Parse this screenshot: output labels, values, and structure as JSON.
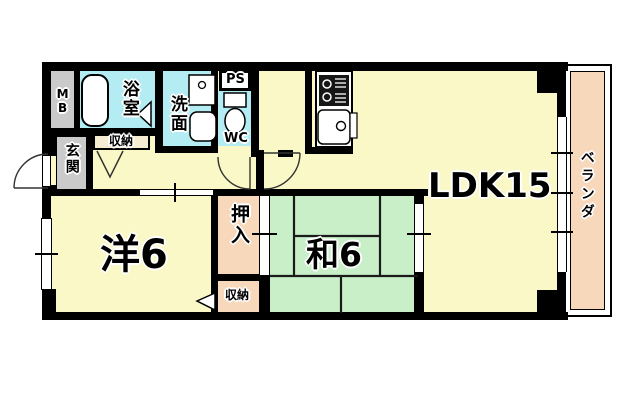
{
  "colors": {
    "floor_yellow": "#FAF8C6",
    "wet_area_cyan": "#B4ECF4",
    "tatami_green": "#C9EFC8",
    "closet_peach": "#F7D8BA",
    "entry_gray": "#CACACA",
    "hall_closet_cream": "#F5ECD2",
    "wall_black": "#000000",
    "background_white": "#FFFFFF"
  },
  "rooms": {
    "ldk": {
      "label": "LDK15"
    },
    "western": {
      "label": "洋6"
    },
    "japanese": {
      "label": "和6"
    },
    "oshiire": {
      "label": "押入"
    },
    "storage_lower": {
      "label": "収納"
    },
    "storage_hall": {
      "label": "収納"
    },
    "genkan": {
      "label": "玄関"
    },
    "bath": {
      "label": "浴室"
    },
    "washroom": {
      "label": "洗面"
    },
    "wc": {
      "label": "WC"
    },
    "ps": {
      "label": "PS"
    },
    "mb": {
      "label": "MB"
    },
    "veranda": {
      "label": "ベランダ"
    }
  },
  "fixtures": [
    "bathtub",
    "washbasin",
    "laundry-pan",
    "toilet",
    "gas-stove",
    "kitchen-sink",
    "door-swing",
    "sliding-window"
  ]
}
